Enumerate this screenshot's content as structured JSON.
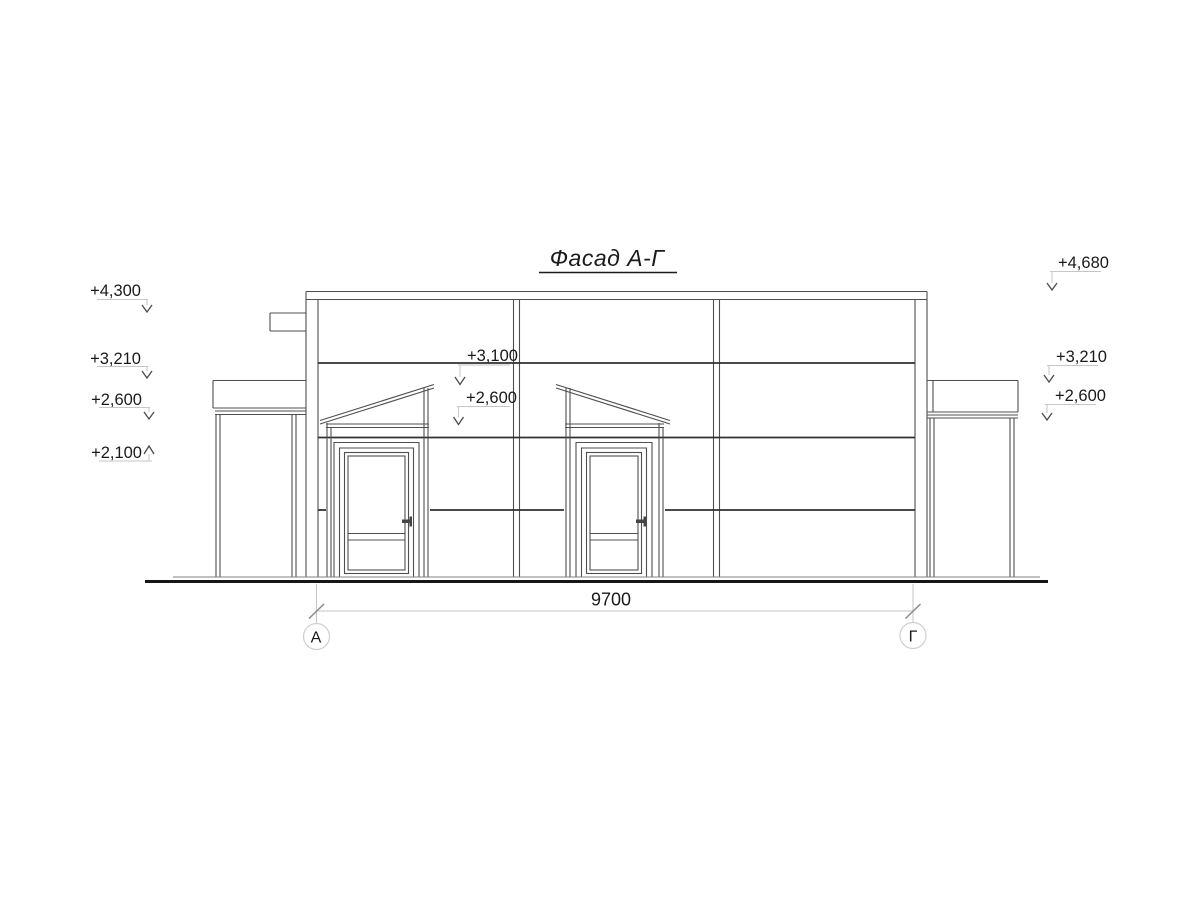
{
  "drawing": {
    "title": "Фасад А-Г",
    "elevation_marks": {
      "left": [
        "+4,300",
        "+3,210",
        "+2,600",
        "+2,100"
      ],
      "middle": [
        "+3,100",
        "+2,600"
      ],
      "right": [
        "+4,680",
        "+3,210",
        "+2,600"
      ]
    },
    "dimension": {
      "value": "9700"
    },
    "axes": {
      "start": "А",
      "end": "Г"
    },
    "colors": {
      "background": "#ffffff",
      "line_main": "#4f4f4f",
      "line_seam": "#303030",
      "line_leader": "#c6c6c6",
      "text": "#1a1a1a"
    }
  }
}
